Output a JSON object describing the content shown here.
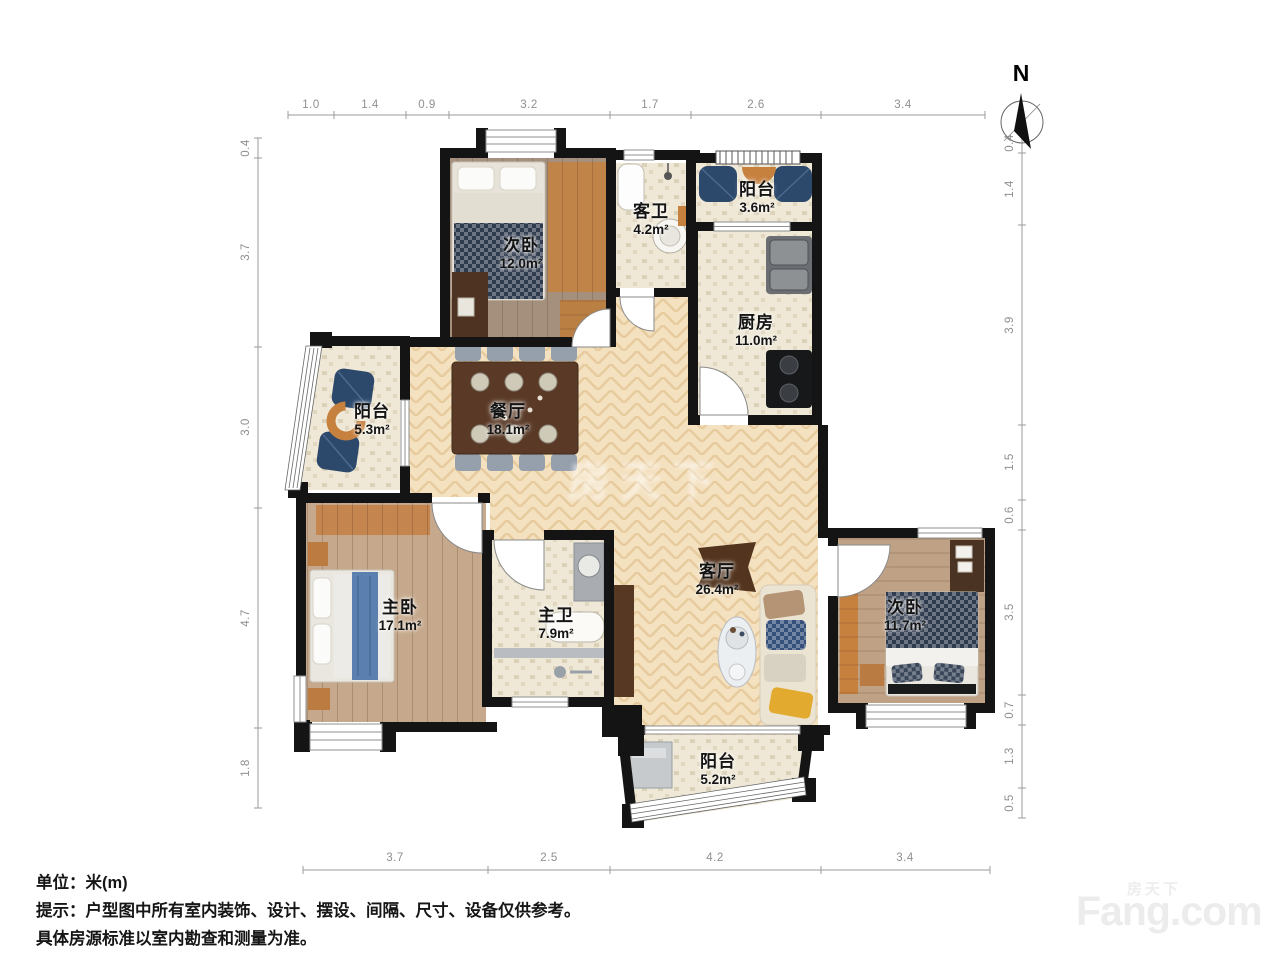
{
  "north": {
    "label": "N"
  },
  "rooms": [
    {
      "name": "次卧",
      "area": "12.0m²"
    },
    {
      "name": "客卫",
      "area": "4.2m²"
    },
    {
      "name": "阳台",
      "area": "3.6m²"
    },
    {
      "name": "厨房",
      "area": "11.0m²"
    },
    {
      "name": "阳台",
      "area": "5.3m²"
    },
    {
      "name": "餐厅",
      "area": "18.1m²"
    },
    {
      "name": "主卧",
      "area": "17.1m²"
    },
    {
      "name": "主卫",
      "area": "7.9m²"
    },
    {
      "name": "客厅",
      "area": "26.4m²"
    },
    {
      "name": "次卧",
      "area": "11.7m²"
    },
    {
      "name": "阳台",
      "area": "5.2m²"
    }
  ],
  "dimensions": {
    "top": [
      "1.0",
      "1.4",
      "0.9",
      "3.2",
      "1.7",
      "2.6",
      "3.4"
    ],
    "left": [
      "0.4",
      "3.7",
      "3.0",
      "4.7",
      "1.8"
    ],
    "right": [
      "0.4",
      "1.4",
      "3.9",
      "1.5",
      "0.6",
      "3.5",
      "0.7",
      "1.3",
      "0.5"
    ],
    "bottom": [
      "3.7",
      "2.5",
      "4.2",
      "3.4"
    ]
  },
  "notes": {
    "unit": "单位：米(m)",
    "tip1": "提示：户型图中所有室内装饰、设计、摆设、间隔、尺寸、设备仅供参考。",
    "tip2": "具体房源标准以室内勘查和测量为准。"
  },
  "watermark": {
    "cn": "房天下",
    "en": "Fang.com"
  },
  "colors": {
    "wall": "#141414",
    "wood_floor": "#f4e1c0",
    "tile": "#efe8d6",
    "plank_dark": "#a5907e",
    "plank_master": "#c6a98c",
    "plank_bedroom2": "#bfa185",
    "accent_orange": "#c7813f",
    "accent_blue": "#2c486b",
    "navy_bedding": "#2e3a4e",
    "table_brown": "#5a3a27",
    "dim_text": "#8f8f8f"
  }
}
